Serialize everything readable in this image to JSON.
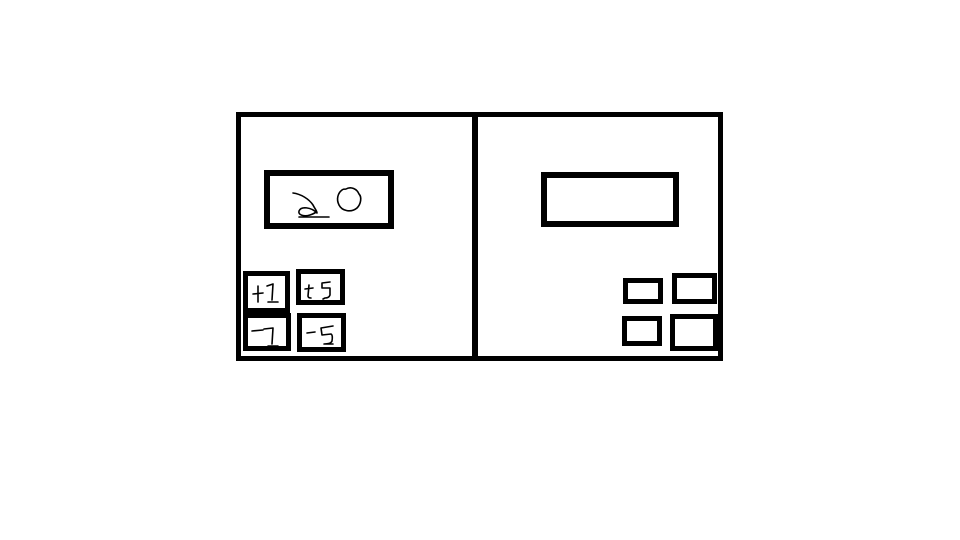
{
  "sketch": {
    "title": "hand-drawn counter wireframe",
    "ink_color": "#000000",
    "background_color": "#ffffff",
    "left_panel": {
      "display_value": "20",
      "buttons": [
        {
          "label": "+1"
        },
        {
          "label": "+5"
        },
        {
          "label": "-1"
        },
        {
          "label": "-5"
        }
      ]
    },
    "right_panel": {
      "display_value": "",
      "buttons": [
        {
          "label": ""
        },
        {
          "label": ""
        },
        {
          "label": ""
        },
        {
          "label": ""
        }
      ]
    }
  }
}
